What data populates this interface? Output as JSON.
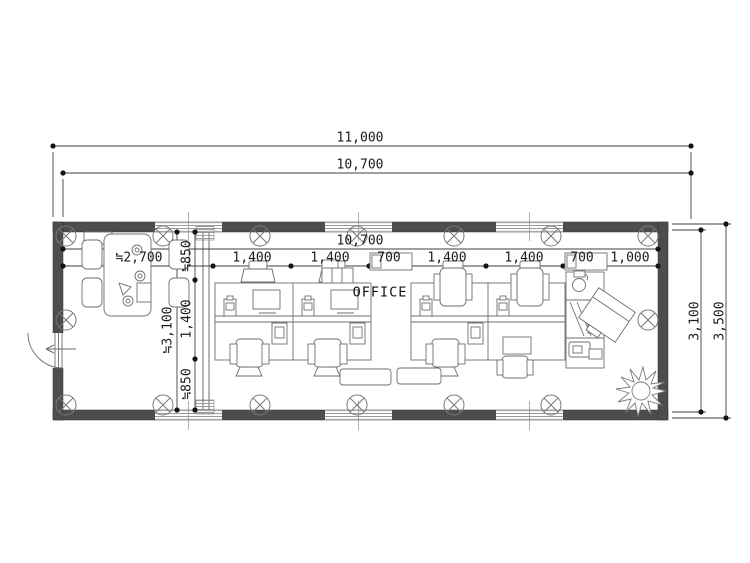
{
  "room": {
    "label": "OFFICE"
  },
  "dimensions": {
    "overall_width": "11,000",
    "wall_width": "10,700",
    "interior_width": "10,700",
    "width_chain": [
      "≒2,700",
      "1,400",
      "1,400",
      "700",
      "1,400",
      "1,400",
      "700",
      "1,000"
    ],
    "left_depth_total": "≒3,100",
    "left_depth_chain": [
      "≒850",
      "1,400",
      "≒850"
    ],
    "right_depth_inner": "3,100",
    "right_depth_outer": "3,500"
  },
  "symbols": [
    "column-circle-x",
    "window-4line",
    "door-swing-arc",
    "entry-arrow",
    "plant",
    "copier",
    "desk-island",
    "office-chair",
    "meeting-table"
  ],
  "colors": {
    "wall_fill": "#4d4d4d",
    "line": "#6e6e6e",
    "dimension_line": "#3f3f3f",
    "background": "#ffffff"
  }
}
